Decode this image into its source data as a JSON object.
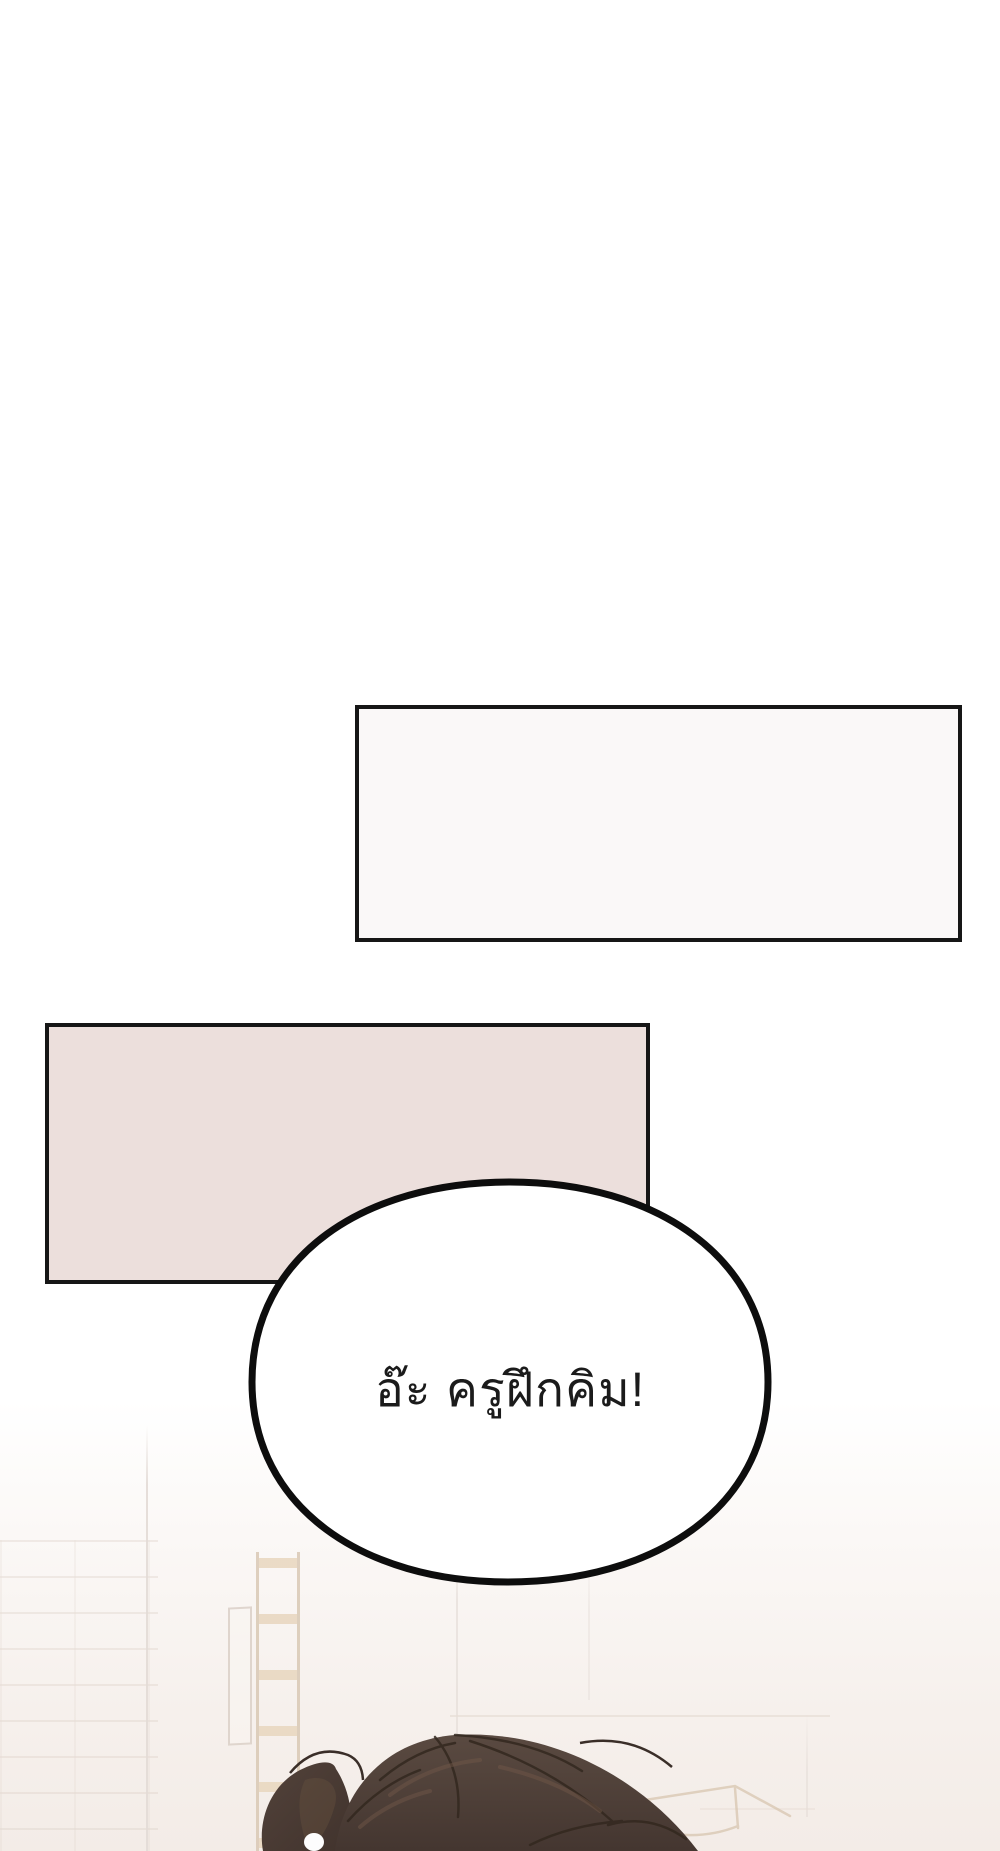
{
  "page": {
    "width_px": 1000,
    "height_px": 1851,
    "background_color": "#ffffff",
    "content_type": "webtoon-comic-page"
  },
  "panels": [
    {
      "id": "top-narration-panel",
      "text": "",
      "fill": "#faf8f8",
      "border_color": "#161616"
    },
    {
      "id": "pink-narration-panel",
      "text": "",
      "fill": "#ecdfdc",
      "border_color": "#161616"
    }
  ],
  "speech_bubble": {
    "text": "อ๊ะ ครูฝึกคิม!",
    "fill": "#ffffff",
    "border_color": "#0d0d0d",
    "text_color": "#1b1b1b"
  },
  "artwork": {
    "scene": "top of character's head in gym with ladder and brick wall",
    "hair_color": "#4e3f38",
    "hair_line_color": "#33281f",
    "hair_highlight_color": "#73594a",
    "wall_tint": "#f3ece7",
    "ladder_color": "#e8d6be",
    "furniture_line_color": "#d8c6b0"
  }
}
